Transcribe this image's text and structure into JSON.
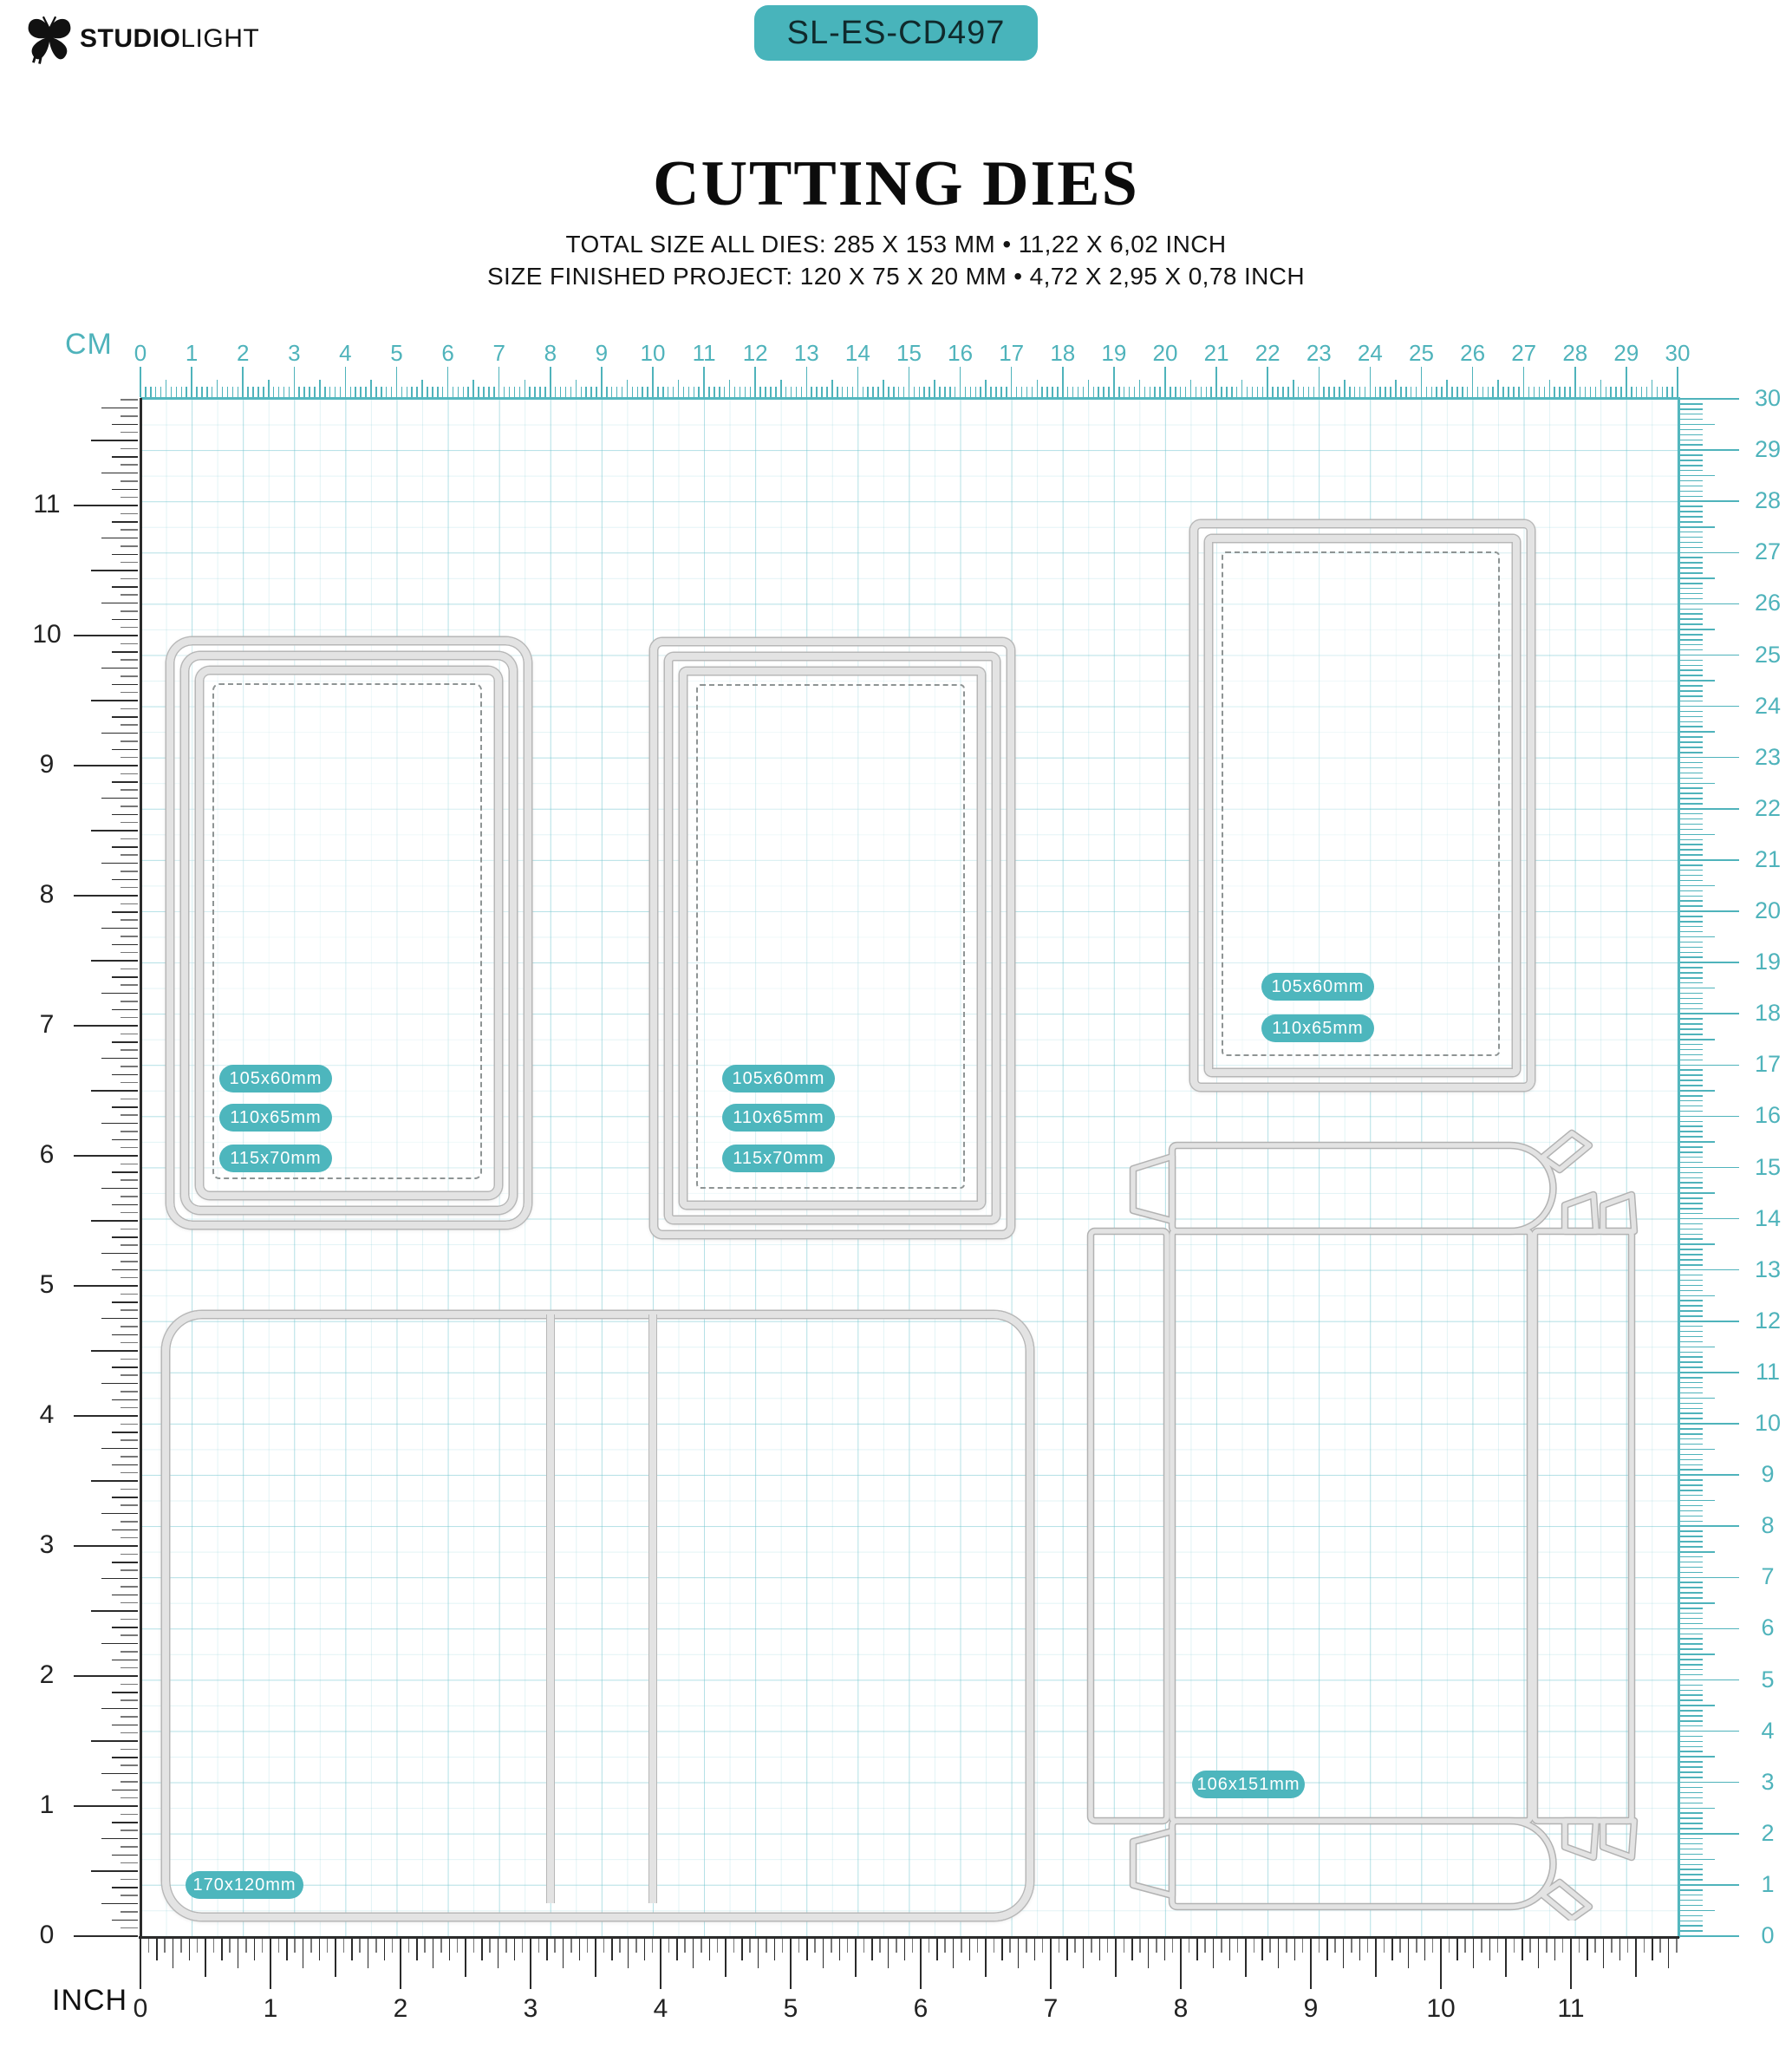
{
  "header": {
    "brand_bold": "STUDIO",
    "brand_light": "LIGHT",
    "badge": "SL-ES-CD497"
  },
  "title": "CUTTING DIES",
  "subtitle_line1": "TOTAL SIZE ALL DIES: 285 X 153 MM • 11,22 X 6,02 INCH",
  "subtitle_line2": "SIZE FINISHED PROJECT: 120 X 75 X 20 MM • 4,72 X 2,95 X 0,78 INCH",
  "colors": {
    "accent": "#48b4bb",
    "pill": "#4db6bd",
    "ruler_teal": "#4fb3bb",
    "ruler_dark": "#2b2b2b",
    "die_band": "#e3e3e3",
    "die_edge": "#b7b7b7",
    "grid_line": "#6fc4ce"
  },
  "rulers": {
    "cm_label": "CM",
    "inch_label": "INCH",
    "top_numbers": [
      "0",
      "1",
      "2",
      "3",
      "4",
      "5",
      "6",
      "7",
      "8",
      "9",
      "10",
      "11",
      "12",
      "13",
      "14",
      "15",
      "16",
      "17",
      "18",
      "19",
      "20",
      "21",
      "22",
      "23",
      "24",
      "25",
      "26",
      "27",
      "28",
      "29",
      "30"
    ],
    "right_numbers": [
      "30",
      "29",
      "28",
      "27",
      "26",
      "25",
      "24",
      "23",
      "22",
      "21",
      "20",
      "19",
      "18",
      "17",
      "16",
      "15",
      "14",
      "13",
      "12",
      "11",
      "10",
      "9",
      "8",
      "7",
      "6",
      "5",
      "4",
      "3",
      "2",
      "1",
      "0"
    ],
    "left_numbers": [
      "11",
      "10",
      "9",
      "8",
      "7",
      "6",
      "5",
      "4",
      "3",
      "2",
      "1",
      "0"
    ],
    "bottom_numbers": [
      "0",
      "1",
      "2",
      "3",
      "4",
      "5",
      "6",
      "7",
      "8",
      "9",
      "10",
      "11"
    ]
  },
  "dies": {
    "frame_a": {
      "labels": [
        "105x60mm",
        "110x65mm",
        "115x70mm"
      ]
    },
    "frame_b": {
      "labels": [
        "105x60mm",
        "110x65mm",
        "115x70mm"
      ]
    },
    "frame_c": {
      "labels": [
        "105x60mm",
        "110x65mm"
      ]
    },
    "folder": {
      "label": "170x120mm"
    },
    "box": {
      "label": "106x151mm"
    }
  }
}
